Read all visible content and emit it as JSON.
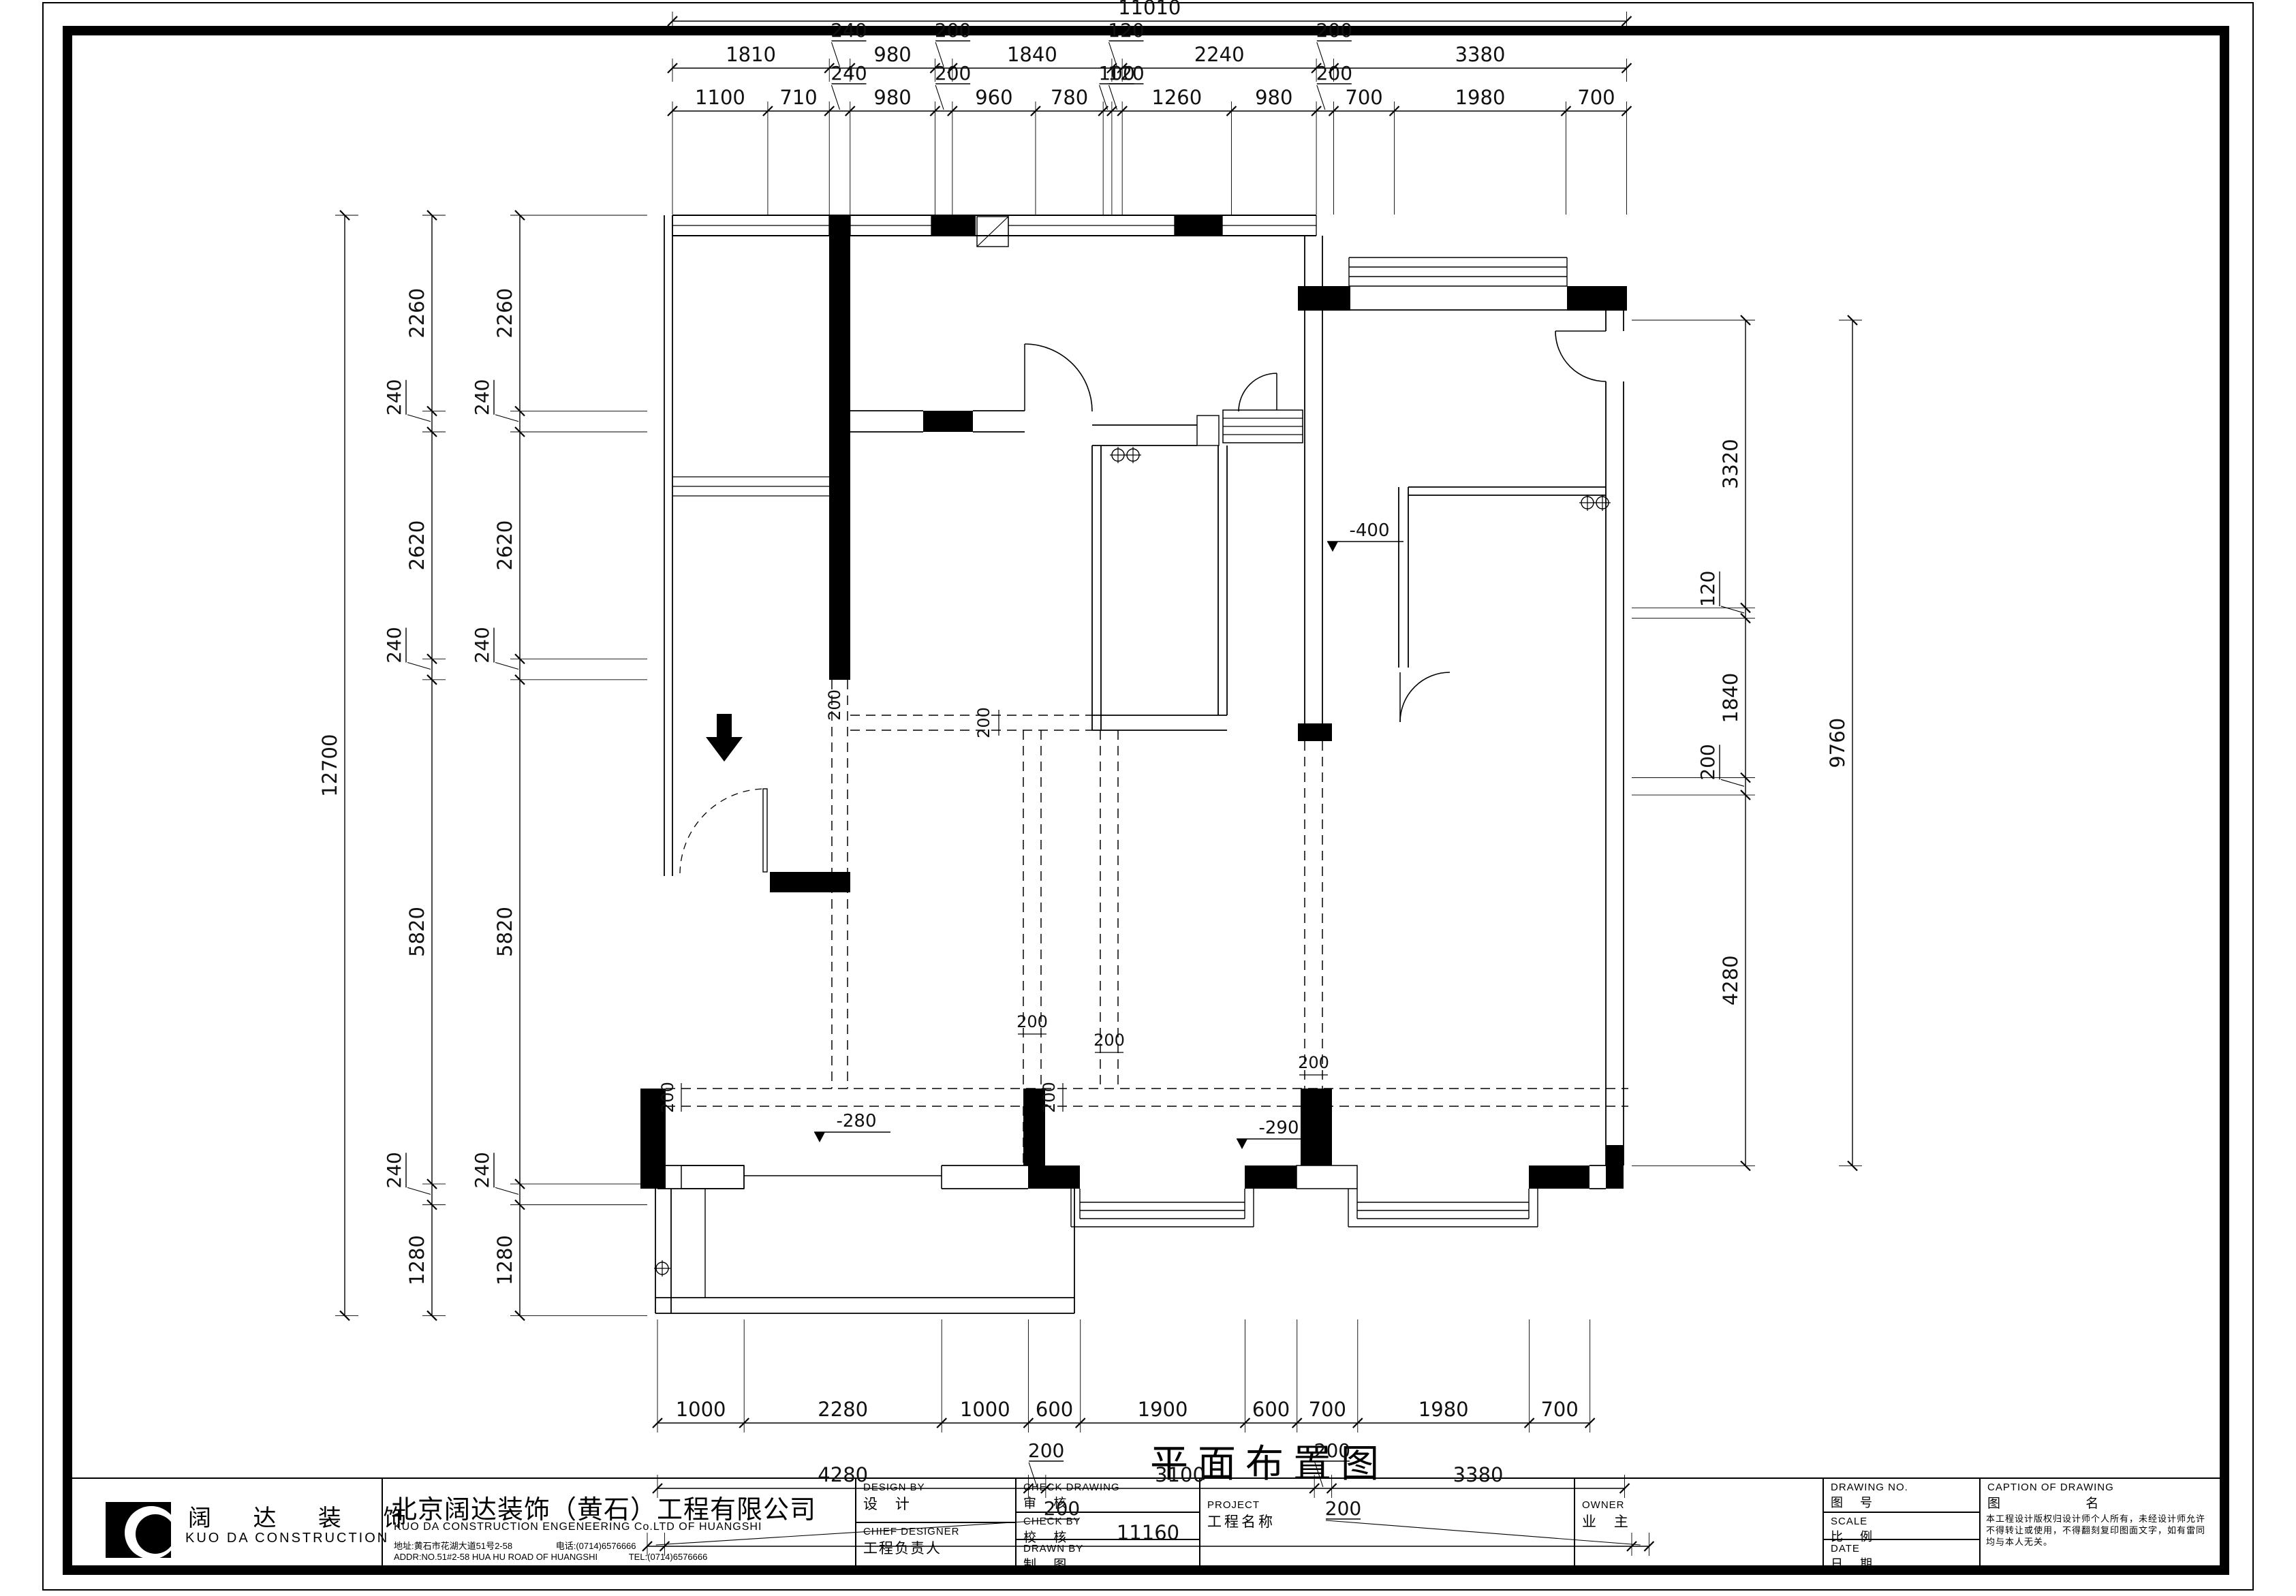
{
  "dimensions": {
    "top": {
      "overall": "11010",
      "row2": [
        "1810",
        "240",
        "980",
        "200",
        "1840",
        "120",
        "2240",
        "200",
        "3380"
      ],
      "row3": [
        "1100",
        "710",
        "240",
        "980",
        "200",
        "960",
        "780",
        "100",
        "120",
        "1260",
        "980",
        "200",
        "700",
        "1980",
        "700"
      ]
    },
    "left": {
      "overall": "12700",
      "col1": [
        "2260",
        "240",
        "2620",
        "240",
        "5820",
        "240",
        "1280"
      ],
      "col2": [
        "2260",
        "240",
        "2620",
        "240",
        "5820",
        "240",
        "1280"
      ]
    },
    "right": {
      "overall": "9760",
      "inner": [
        "3320",
        "120",
        "1840",
        "200",
        "4280"
      ]
    },
    "bottom": {
      "row1": [
        "1000",
        "2280",
        "1000",
        "600",
        "1900",
        "600",
        "700",
        "1980",
        "700"
      ],
      "row2": [
        "4280",
        "200",
        "3100",
        "200",
        "3380"
      ],
      "row3": [
        "200",
        "11160",
        "200"
      ]
    }
  },
  "annotations": {
    "drawing_title": "平面布置图",
    "levels": [
      "-400",
      "-280",
      "-290"
    ],
    "beam_dims": [
      "200",
      "200",
      "200",
      "200",
      "200",
      "200",
      "200"
    ]
  },
  "title_block": {
    "logo_cn": "阔 达 装 饰",
    "logo_en": "KUO DA CONSTRUCTION",
    "company_cn": "北京阔达装饰（黄石）工程有限公司",
    "company_en": "KUO DA CONSTRUCTION ENGENEERING Co.LTD OF HUANGSHI",
    "address_cn": "地址:黄石市花湖大道51号2-58",
    "tel_cn": "电话:(0714)6576666",
    "address_en": "ADDR:NO.51#2-58 HUA HU ROAD OF HUANGSHI",
    "tel_en": "TEL:(0714)6576666",
    "design_by_en": "DESIGN BY",
    "design_by_cn": "设 计",
    "chief_designer_en": "CHIEF DESIGNER",
    "chief_designer_cn": "工程负责人",
    "check_drawing_en": "CHECK DRAWING",
    "check_drawing_cn": "审 核",
    "check_by_en": "CHECK BY",
    "check_by_cn": "校 核",
    "drawn_by_en": "DRAWN BY",
    "drawn_by_cn": "制 图",
    "project_en": "PROJECT",
    "project_cn": "工程名称",
    "owner_en": "OWNER",
    "owner_cn": "业 主",
    "drawing_no_en": "DRAWING NO.",
    "drawing_no_cn": "图 号",
    "scale_en": "SCALE",
    "scale_cn": "比 例",
    "date_en": "DATE",
    "date_cn": "日 期",
    "caption_en": "CAPTION OF DRAWING",
    "caption_cn": "图 名",
    "note": "本工程设计版权归设计师个人所有，未经设计师允许不得转让或使用，不得翻刻复印图面文字，如有雷同均与本人无关。"
  }
}
